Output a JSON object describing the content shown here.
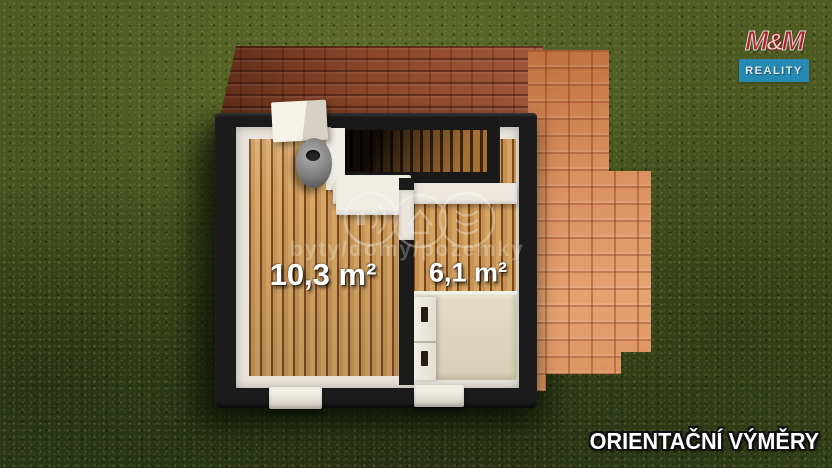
{
  "scene": {
    "footer": "ORIENTAČNÍ VÝMĚRY",
    "rooms": [
      {
        "name": "main room",
        "area_label": "10,3 m²"
      },
      {
        "name": "side room",
        "area_label": "6,1 m²"
      }
    ],
    "watermark": {
      "text": "byty/domy/pozemky"
    },
    "logo": {
      "m_left": "M",
      "amp": "&",
      "m_right": "M",
      "bottom": "REALITY"
    },
    "colors": {
      "grass": "#46541f",
      "roof_dark": "#8b4628",
      "roof_light": "#d98e5e",
      "wall_cut": "#1b1b1b",
      "wall_inner": "#e9e5dc",
      "floor_wood": "#c89758",
      "bed": "#ddd4bd",
      "logo_red": "#b5202c",
      "logo_blue": "#2090c4"
    }
  }
}
